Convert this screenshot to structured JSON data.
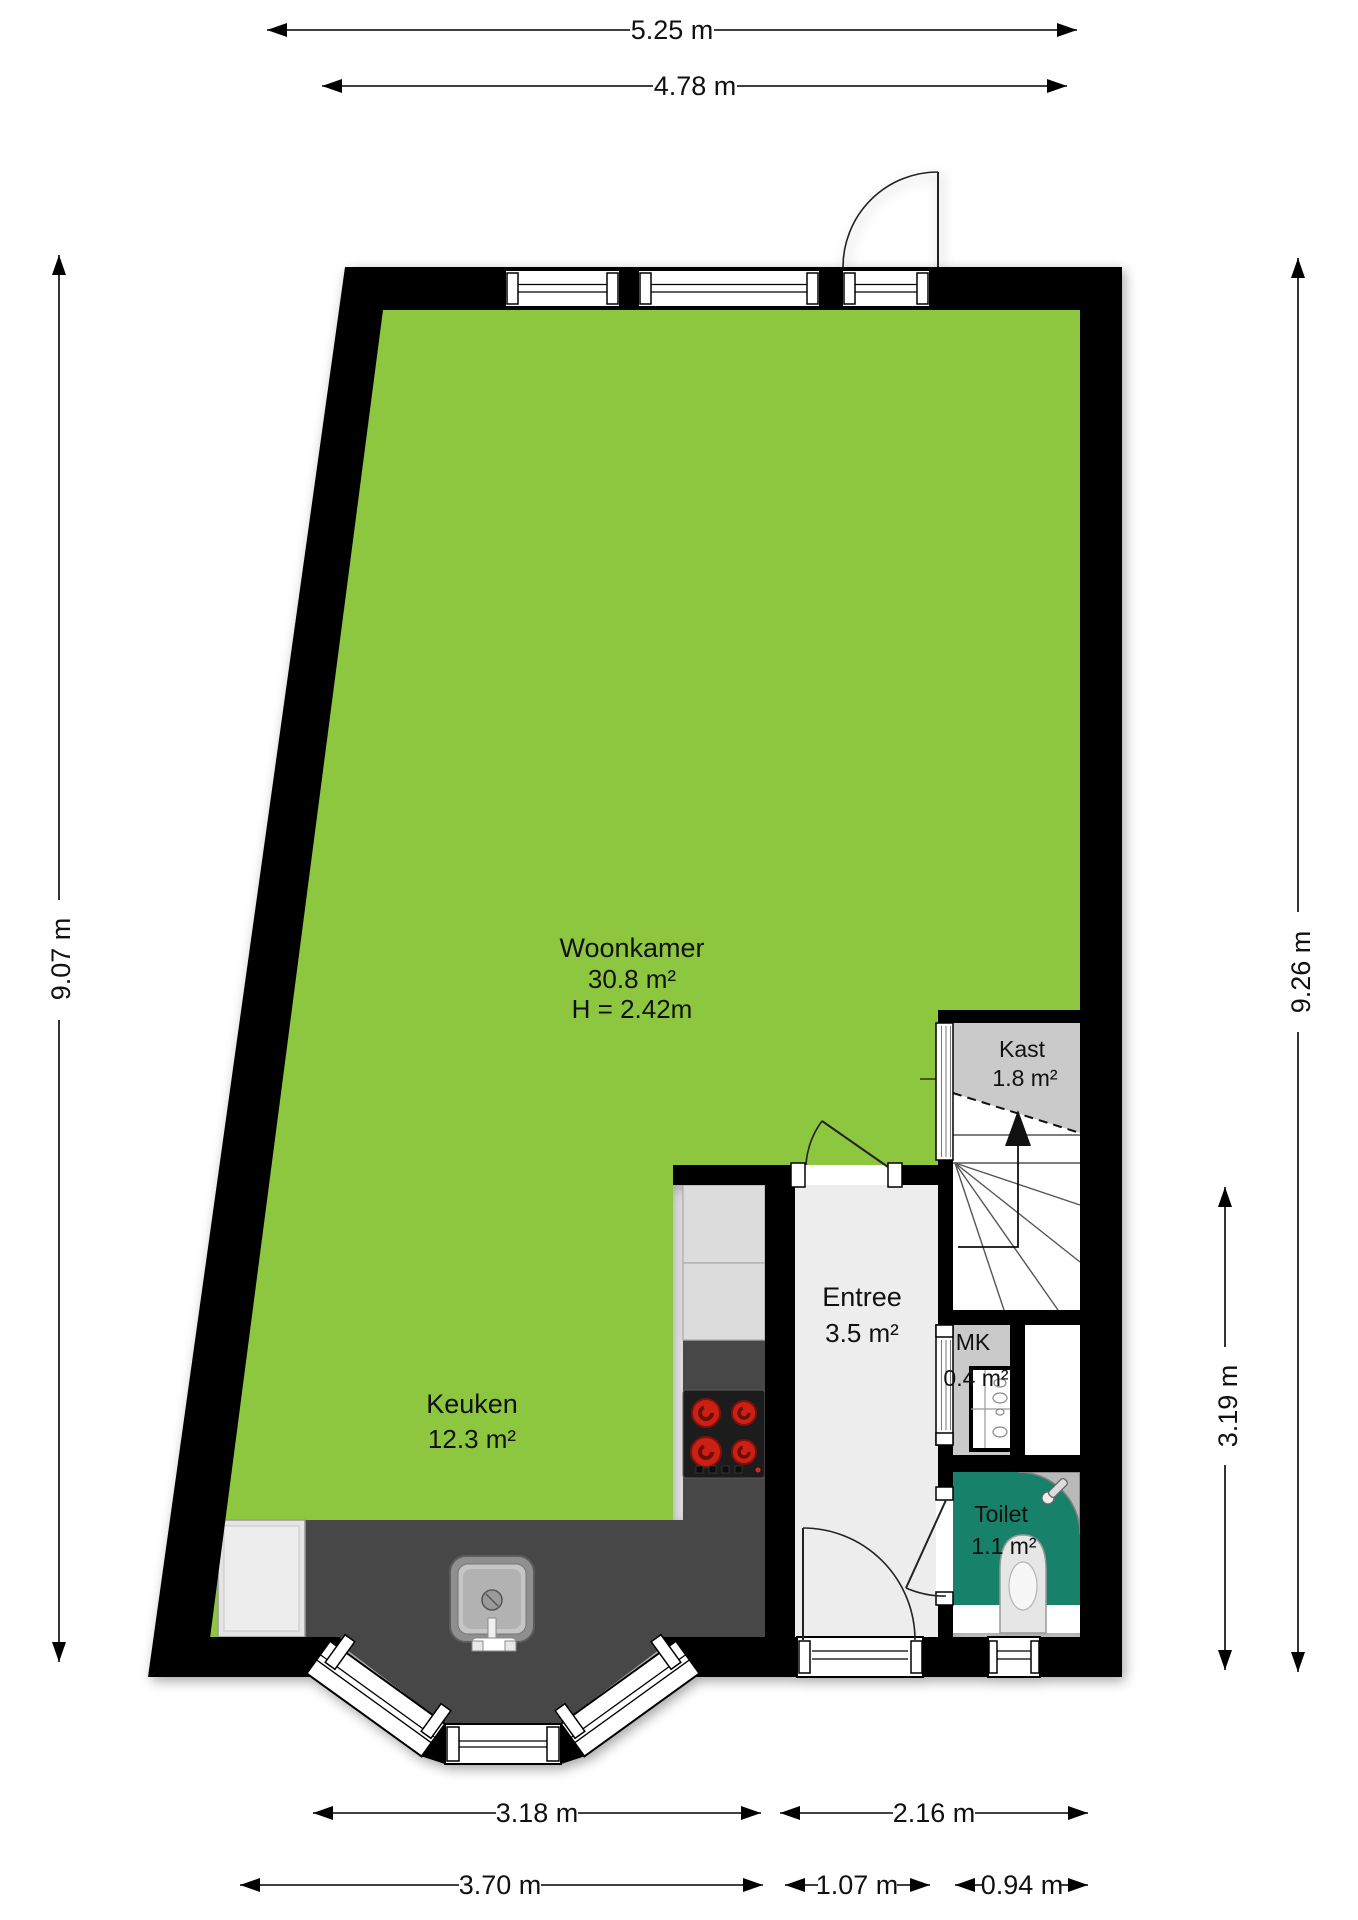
{
  "plan": {
    "rooms": [
      {
        "name": "Woonkamer",
        "area": "30.8 m²",
        "ceiling_height": "H = 2.42m"
      },
      {
        "name": "Keuken",
        "area": "12.3 m²"
      },
      {
        "name": "Entree",
        "area": "3.5 m²"
      },
      {
        "name": "Kast",
        "area": "1.8 m²"
      },
      {
        "name": "MK",
        "area": "0.4 m²"
      },
      {
        "name": "Toilet",
        "area": "1.1 m²"
      }
    ],
    "dimensions": {
      "top": [
        {
          "label": "5.25 m"
        },
        {
          "label": "4.78 m"
        }
      ],
      "left": [
        {
          "label": "9.07 m"
        }
      ],
      "right": [
        {
          "label": "9.26 m"
        },
        {
          "label": "3.19 m"
        }
      ],
      "bottom_upper": [
        {
          "label": "3.18 m"
        },
        {
          "label": "2.16 m"
        }
      ],
      "bottom_lower": [
        {
          "label": "3.70 m"
        },
        {
          "label": "1.07 m"
        },
        {
          "label": "0.94 m"
        }
      ]
    },
    "colors": {
      "wall": "#000000",
      "living_floor": "#8dc63f",
      "hall_floor": "#ededed",
      "closet_floor": "#cacaca",
      "toilet_floor": "#178169",
      "counter": "#474747",
      "cabinet": "#dcdcdc",
      "stairs": "#ffffff",
      "burner": "#cc2015"
    },
    "stairs_direction": "up"
  }
}
